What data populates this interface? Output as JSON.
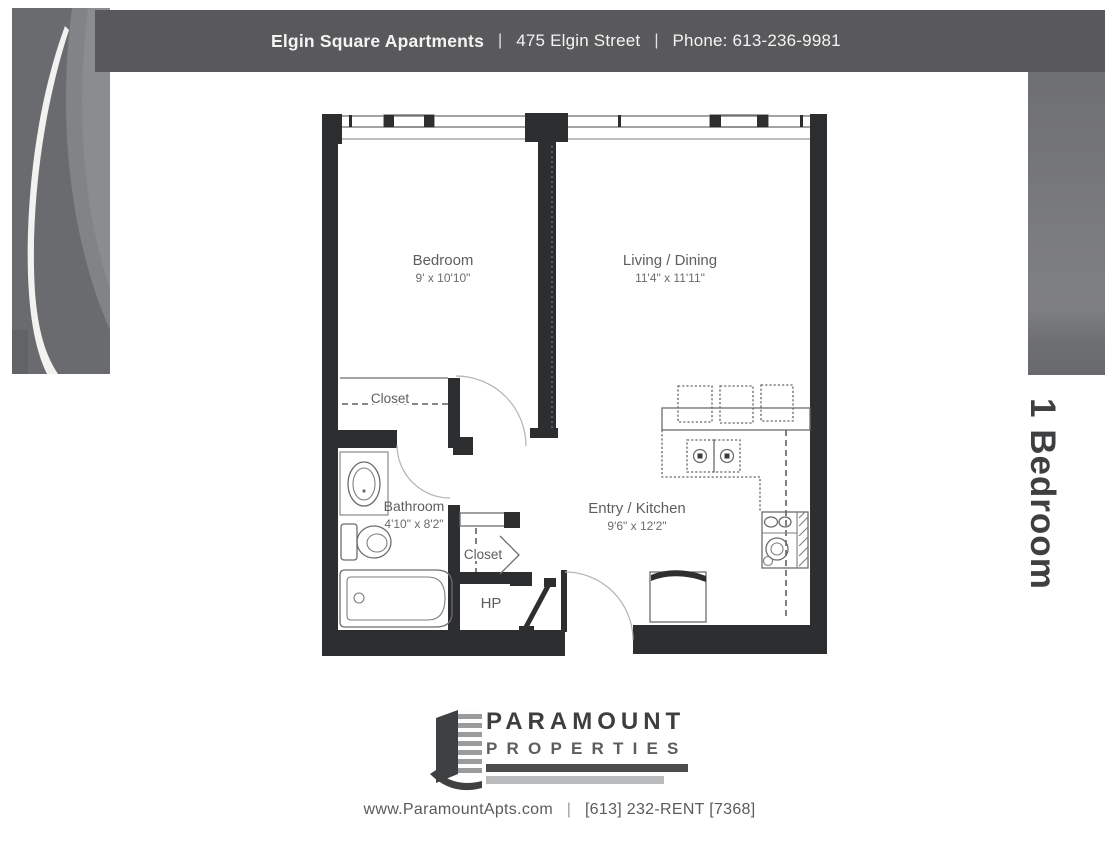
{
  "header": {
    "building": "Elgin Square Apartments",
    "separator": "|",
    "address": "475 Elgin Street",
    "phone": "Phone: 613-236-9981"
  },
  "plan": {
    "type_label": "1 Bedroom"
  },
  "floorplan": {
    "bedroom": {
      "name": "Bedroom",
      "dims": "9' x 10'10\""
    },
    "living": {
      "name": "Living / Dining",
      "dims": "11'4\" x 11'11\""
    },
    "bathroom": {
      "name": "Bathroom",
      "dims": "4'10\" x 8'2\""
    },
    "entry_kitchen": {
      "name": "Entry / Kitchen",
      "dims": "9'6\" x 12'2\""
    },
    "bedroom_closet": {
      "name": "Closet"
    },
    "hall_closet": {
      "name": "Closet"
    },
    "heat_pump": {
      "name": "HP"
    }
  },
  "logo": {
    "name_line": "PARAMOUNT",
    "sub_line": "PROPERTIES"
  },
  "footer": {
    "website": "www.ParamountApts.com",
    "separator": "|",
    "phone": "[613] 232-RENT [7368]"
  },
  "colors": {
    "header_bg": "#59595b",
    "band_gray": "#77787b",
    "wall": "#2d2e30",
    "label_gray": "#5d5e60",
    "logo_dark": "#3d3e40"
  }
}
